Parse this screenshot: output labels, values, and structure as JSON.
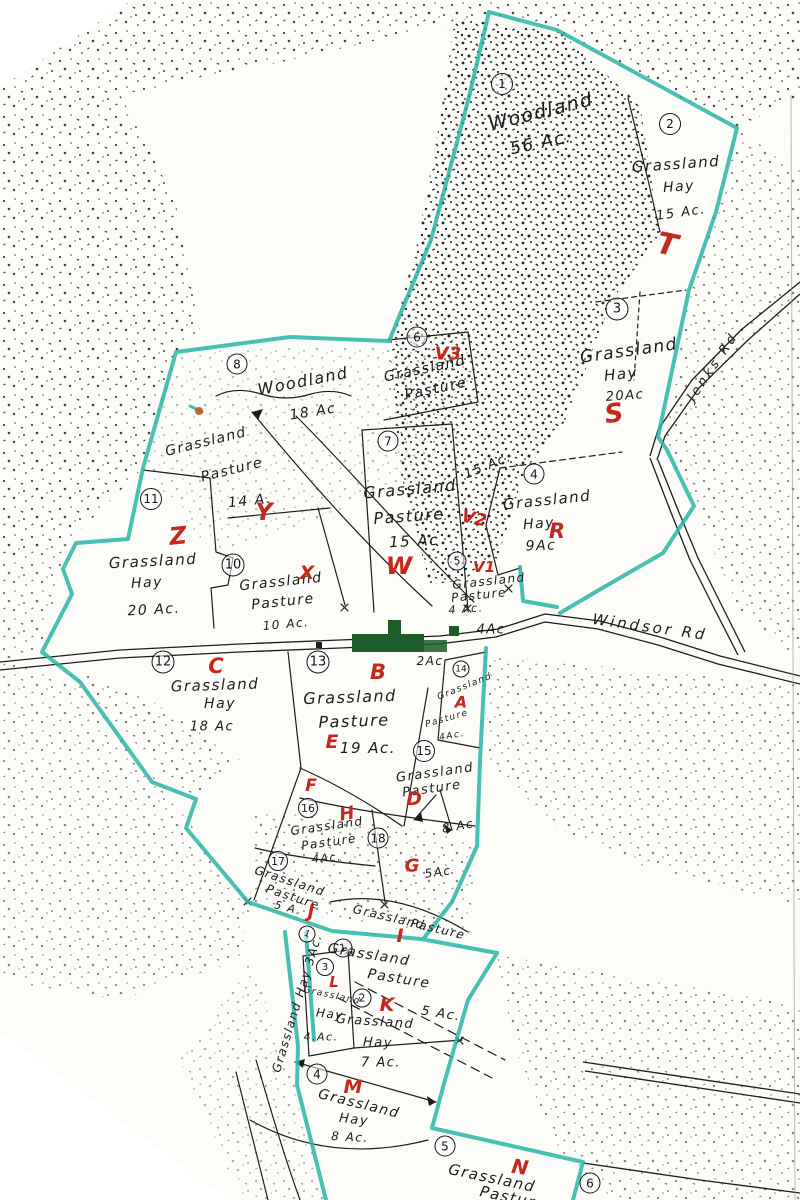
{
  "map": {
    "colors": {
      "boundary_teal": "#2ab5a6",
      "letter_red": "#c6281c",
      "building_green": "#1e5c2a",
      "ink_black": "#1c1c1c",
      "paper": "#fcfcf9",
      "scan_orange_mark": "#c05a20"
    },
    "roads": [
      {
        "label": "Windsor Rd",
        "x": 650,
        "y": 627,
        "r": 8,
        "s": 15
      },
      {
        "label": "Jenks Rd",
        "x": 713,
        "y": 367,
        "r": -56,
        "s": 13
      }
    ],
    "regions": [
      {
        "number": "1",
        "nx": 502,
        "ny": 84,
        "d": 20,
        "texts": [
          {
            "t": "Woodland",
            "x": 541,
            "y": 112,
            "r": -14,
            "s": 19
          },
          {
            "t": "56 Ac.",
            "x": 541,
            "y": 143,
            "r": -12,
            "s": 17
          }
        ]
      },
      {
        "number": "2",
        "nx": 670,
        "ny": 124,
        "d": 20,
        "texts": [
          {
            "t": "Grassland",
            "x": 676,
            "y": 164,
            "r": -4,
            "s": 15
          },
          {
            "t": "Hay",
            "x": 679,
            "y": 187,
            "r": -4,
            "s": 14
          },
          {
            "t": "15 Ac.",
            "x": 681,
            "y": 213,
            "r": -8,
            "s": 13
          }
        ],
        "letter": {
          "t": "T",
          "x": 667,
          "y": 245,
          "r": 12,
          "s": 30
        }
      },
      {
        "number": "3",
        "nx": 617,
        "ny": 309,
        "d": 21,
        "texts": [
          {
            "t": "Grassland",
            "x": 629,
            "y": 351,
            "r": -8,
            "s": 17
          },
          {
            "t": "Hay",
            "x": 621,
            "y": 374,
            "r": -6,
            "s": 15
          },
          {
            "t": "20Ac",
            "x": 625,
            "y": 396,
            "r": -4,
            "s": 13
          }
        ],
        "letter": {
          "t": "S",
          "x": 614,
          "y": 414,
          "r": -8,
          "s": 26
        }
      },
      {
        "number": "4",
        "nx": 534,
        "ny": 474,
        "d": 19,
        "texts": [
          {
            "t": "Grassland",
            "x": 547,
            "y": 500,
            "r": -6,
            "s": 15
          },
          {
            "t": "Hay",
            "x": 539,
            "y": 524,
            "r": -4,
            "s": 14
          },
          {
            "t": "9Ac",
            "x": 541,
            "y": 546,
            "r": -2,
            "s": 14
          }
        ],
        "letter": {
          "t": "R",
          "x": 557,
          "y": 531,
          "r": 0,
          "s": 21
        }
      },
      {
        "number": "5",
        "nx": 457,
        "ny": 561,
        "d": 17,
        "texts": [
          {
            "t": "Grassland",
            "x": 489,
            "y": 581,
            "r": -6,
            "s": 12
          },
          {
            "t": "Pasture",
            "x": 479,
            "y": 595,
            "r": -6,
            "s": 12
          },
          {
            "t": "4 Ac.",
            "x": 466,
            "y": 609,
            "r": -4,
            "s": 11
          }
        ],
        "letter": {
          "t": "V1",
          "x": 484,
          "y": 567,
          "r": 0,
          "s": 15
        }
      },
      {
        "number": "6",
        "nx": 417,
        "ny": 337,
        "d": 19,
        "texts": [
          {
            "t": "Grassland",
            "x": 425,
            "y": 369,
            "r": -12,
            "s": 14
          },
          {
            "t": "Pasture",
            "x": 436,
            "y": 389,
            "r": -12,
            "s": 14
          }
        ],
        "letter": {
          "t": "V3",
          "x": 448,
          "y": 354,
          "r": 0,
          "s": 18
        }
      },
      {
        "number": "7",
        "nx": 388,
        "ny": 441,
        "d": 19,
        "texts": [
          {
            "t": "Grassland",
            "x": 410,
            "y": 489,
            "r": -5,
            "s": 16
          },
          {
            "t": "Pasture",
            "x": 409,
            "y": 516,
            "r": -4,
            "s": 16
          },
          {
            "t": "15 Ac",
            "x": 414,
            "y": 541,
            "r": -3,
            "s": 15
          }
        ],
        "letter": {
          "t": "W",
          "x": 399,
          "y": 566,
          "r": 0,
          "s": 24
        }
      },
      {
        "number": "8",
        "nx": 237,
        "ny": 364,
        "d": 19,
        "texts": [
          {
            "t": "Woodland",
            "x": 303,
            "y": 381,
            "r": -11,
            "s": 16
          },
          {
            "t": "18 Ac",
            "x": 313,
            "y": 412,
            "r": -9,
            "s": 14
          }
        ]
      },
      {
        "number": null,
        "texts": [
          {
            "t": "Grassland",
            "x": 206,
            "y": 442,
            "r": -14,
            "s": 14
          },
          {
            "t": "Pasture",
            "x": 232,
            "y": 470,
            "r": -14,
            "s": 14
          },
          {
            "t": "14 A.",
            "x": 250,
            "y": 501,
            "r": -6,
            "s": 14
          }
        ],
        "letter": {
          "t": "Y",
          "x": 264,
          "y": 512,
          "r": 0,
          "s": 24
        }
      },
      {
        "number": "10",
        "nx": 233,
        "ny": 565,
        "d": 21,
        "texts": [
          {
            "t": "Grassland",
            "x": 281,
            "y": 582,
            "r": -6,
            "s": 14
          },
          {
            "t": "Pasture",
            "x": 283,
            "y": 602,
            "r": -6,
            "s": 14
          },
          {
            "t": "10 Ac.",
            "x": 286,
            "y": 624,
            "r": -5,
            "s": 12
          }
        ],
        "letter": {
          "t": "X",
          "x": 307,
          "y": 573,
          "r": 0,
          "s": 19
        }
      },
      {
        "number": "11",
        "nx": 151,
        "ny": 499,
        "d": 20,
        "texts": [
          {
            "t": "Grassland",
            "x": 153,
            "y": 561,
            "r": -3,
            "s": 15
          },
          {
            "t": "Hay",
            "x": 147,
            "y": 583,
            "r": -3,
            "s": 14
          },
          {
            "t": "20 Ac.",
            "x": 154,
            "y": 610,
            "r": -3,
            "s": 14
          }
        ],
        "letter": {
          "t": "Z",
          "x": 178,
          "y": 536,
          "r": -6,
          "s": 24
        }
      },
      {
        "number": "12",
        "nx": 163,
        "ny": 662,
        "d": 21,
        "texts": [
          {
            "t": "Grassland",
            "x": 215,
            "y": 685,
            "r": -2,
            "s": 15
          },
          {
            "t": "Hay",
            "x": 220,
            "y": 704,
            "r": 0,
            "s": 14
          },
          {
            "t": "18 Ac",
            "x": 212,
            "y": 727,
            "r": 0,
            "s": 13
          }
        ],
        "letter": {
          "t": "C",
          "x": 216,
          "y": 666,
          "r": 0,
          "s": 21
        }
      },
      {
        "number": "13",
        "nx": 318,
        "ny": 662,
        "d": 21,
        "texts": [
          {
            "t": "Grassland",
            "x": 350,
            "y": 697,
            "r": -2,
            "s": 16
          },
          {
            "t": "Pasture",
            "x": 354,
            "y": 721,
            "r": -2,
            "s": 16
          },
          {
            "t": "19 Ac.",
            "x": 368,
            "y": 748,
            "r": 0,
            "s": 15
          }
        ],
        "letter": {
          "t": "B",
          "x": 378,
          "y": 672,
          "r": 0,
          "s": 21
        }
      },
      {
        "number": "14",
        "nx": 461,
        "ny": 669,
        "d": 15,
        "texts": [
          {
            "t": "Grassland",
            "x": 465,
            "y": 687,
            "r": -22,
            "s": 9
          },
          {
            "t": "Pasture",
            "x": 447,
            "y": 719,
            "r": -16,
            "s": 9
          },
          {
            "t": "4Ac.",
            "x": 452,
            "y": 736,
            "r": -10,
            "s": 9
          }
        ],
        "letter": {
          "t": "A",
          "x": 461,
          "y": 702,
          "r": 0,
          "s": 16
        }
      },
      {
        "number": "15",
        "nx": 424,
        "ny": 751,
        "d": 20,
        "texts": [
          {
            "t": "Grassland",
            "x": 435,
            "y": 773,
            "r": -8,
            "s": 13
          },
          {
            "t": "Pasture",
            "x": 432,
            "y": 789,
            "r": -8,
            "s": 13
          },
          {
            "t": "8 Ac",
            "x": 458,
            "y": 826,
            "r": -10,
            "s": 12
          }
        ],
        "letter": {
          "t": "D",
          "x": 414,
          "y": 799,
          "r": 0,
          "s": 19
        }
      },
      {
        "number": "16",
        "nx": 308,
        "ny": 808,
        "d": 18,
        "texts": [
          {
            "t": "Grassland",
            "x": 327,
            "y": 826,
            "r": -8,
            "s": 12
          },
          {
            "t": "Pasture",
            "x": 329,
            "y": 842,
            "r": -8,
            "s": 12
          },
          {
            "t": "4Ac.",
            "x": 327,
            "y": 858,
            "r": -5,
            "s": 11
          }
        ],
        "letter": {
          "t": "H",
          "x": 347,
          "y": 814,
          "r": -10,
          "s": 18
        }
      },
      {
        "number": "17",
        "nx": 278,
        "ny": 861,
        "d": 18,
        "texts": [
          {
            "t": "Grassland",
            "x": 290,
            "y": 881,
            "r": 18,
            "s": 12
          },
          {
            "t": "Pasture",
            "x": 293,
            "y": 897,
            "r": 18,
            "s": 12
          },
          {
            "t": "5 A.",
            "x": 288,
            "y": 908,
            "r": 14,
            "s": 11
          }
        ],
        "letter": {
          "t": "J",
          "x": 311,
          "y": 912,
          "r": 0,
          "s": 18
        }
      },
      {
        "number": "18",
        "nx": 378,
        "ny": 838,
        "d": 19,
        "texts": [
          {
            "t": "5Ac",
            "x": 438,
            "y": 872,
            "r": -8,
            "s": 12
          }
        ],
        "letter": {
          "t": "G",
          "x": 412,
          "y": 866,
          "r": 0,
          "s": 18
        }
      },
      {
        "number": null,
        "texts": [
          {
            "t": "Grassland",
            "x": 389,
            "y": 917,
            "r": 13,
            "s": 12
          },
          {
            "t": "Pasture",
            "x": 438,
            "y": 929,
            "r": 13,
            "s": 12
          }
        ],
        "letter": {
          "t": "I",
          "x": 400,
          "y": 936,
          "r": 0,
          "s": 19
        }
      },
      {
        "number": "1",
        "nx": 343,
        "ny": 948,
        "d": 17,
        "nr": -15,
        "texts": [
          {
            "t": "Grassland",
            "x": 369,
            "y": 955,
            "r": 9,
            "s": 14
          },
          {
            "t": "Pasture",
            "x": 399,
            "y": 979,
            "r": 9,
            "s": 14
          },
          {
            "t": "5 Ac.",
            "x": 441,
            "y": 1014,
            "r": 9,
            "s": 13
          }
        ]
      },
      {
        "number": "2",
        "nx": 362,
        "ny": 998,
        "d": 17,
        "texts": [
          {
            "t": "Grassland",
            "x": 375,
            "y": 1022,
            "r": 4,
            "s": 13
          },
          {
            "t": "Hay",
            "x": 378,
            "y": 1043,
            "r": 2,
            "s": 13
          },
          {
            "t": "7 Ac.",
            "x": 381,
            "y": 1063,
            "r": 0,
            "s": 13
          }
        ],
        "letter": {
          "t": "K",
          "x": 387,
          "y": 1005,
          "r": 0,
          "s": 19
        }
      },
      {
        "number": "3",
        "nx": 325,
        "ny": 967,
        "d": 16,
        "texts": [
          {
            "t": "Grassland",
            "x": 332,
            "y": 996,
            "r": 12,
            "s": 9
          },
          {
            "t": "Hay",
            "x": 330,
            "y": 1014,
            "r": 6,
            "s": 12
          },
          {
            "t": "4.Ac.",
            "x": 321,
            "y": 1037,
            "r": 0,
            "s": 11
          }
        ],
        "letter": {
          "t": "L",
          "x": 334,
          "y": 982,
          "r": 0,
          "s": 15
        }
      },
      {
        "number": "4",
        "nx": 317,
        "ny": 1074,
        "d": 19,
        "texts": [
          {
            "t": "Grassland",
            "x": 359,
            "y": 1104,
            "r": 14,
            "s": 14
          },
          {
            "t": "Hay",
            "x": 354,
            "y": 1120,
            "r": 6,
            "s": 13
          },
          {
            "t": "8 Ac.",
            "x": 350,
            "y": 1137,
            "r": 3,
            "s": 12
          }
        ],
        "letter": {
          "t": "M",
          "x": 353,
          "y": 1087,
          "r": 0,
          "s": 19
        }
      },
      {
        "number": "5",
        "nx": 445,
        "ny": 1146,
        "d": 19,
        "texts": [
          {
            "t": "Grassland",
            "x": 492,
            "y": 1178,
            "r": 12,
            "s": 15
          },
          {
            "t": "Pasture",
            "x": 513,
            "y": 1198,
            "r": 12,
            "s": 15
          }
        ],
        "letter": {
          "t": "N",
          "x": 520,
          "y": 1167,
          "r": 8,
          "s": 20
        }
      },
      {
        "number": "6",
        "nx": 590,
        "ny": 1183,
        "d": 19,
        "texts": []
      },
      {
        "number": "1",
        "nx": 307,
        "ny": 934,
        "d": 15,
        "nr": 20,
        "texts": [
          {
            "t": "Grassland Hay 3Ac.",
            "x": 297,
            "y": 1003,
            "r": -73,
            "s": 12
          }
        ]
      }
    ],
    "extra_letters": [
      {
        "t": "E",
        "x": 332,
        "y": 742,
        "r": 0,
        "s": 19
      },
      {
        "t": "V2",
        "x": 474,
        "y": 519,
        "r": 12,
        "s": 17
      },
      {
        "t": "F",
        "x": 311,
        "y": 786,
        "r": 0,
        "s": 17
      }
    ],
    "extra_texts": [
      {
        "t": "4Ac",
        "x": 491,
        "y": 630,
        "r": 0,
        "s": 13
      },
      {
        "t": "15 Ac.",
        "x": 488,
        "y": 466,
        "r": -22,
        "s": 13
      },
      {
        "t": "2Ac",
        "x": 430,
        "y": 661,
        "r": 0,
        "s": 12
      }
    ]
  }
}
